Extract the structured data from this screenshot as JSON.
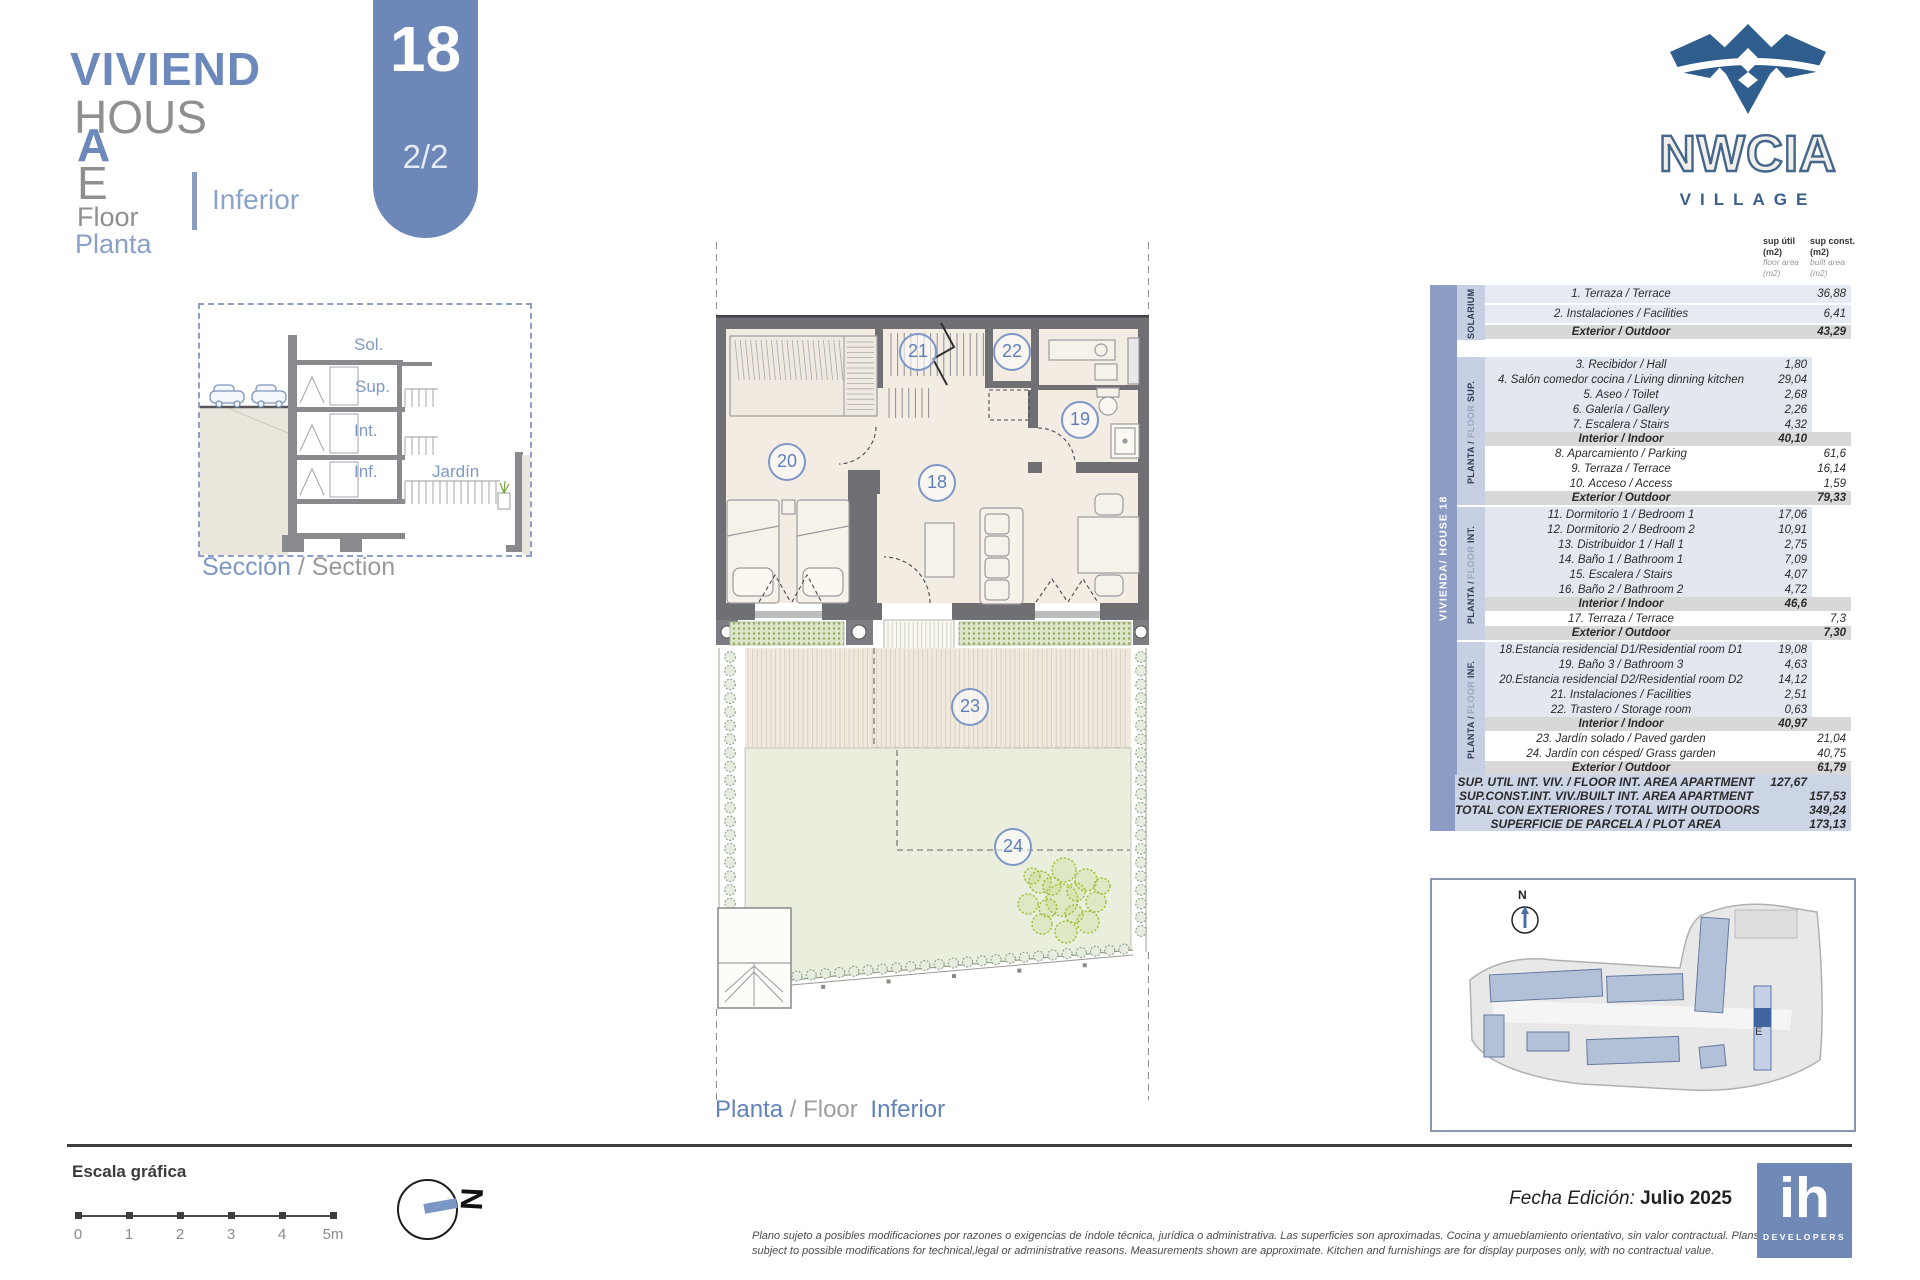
{
  "colors": {
    "accent_blue": "#6d87b8",
    "brand_blue": "#2e5d8e",
    "table_bar": "#8d9cc2"
  },
  "header": {
    "title_es_main": "VIVIEND",
    "title_es_wrap": "A",
    "title_en_main": "HOUS",
    "title_en_wrap": "E",
    "floor_label_en": "Floor",
    "floor_label_es": "Planta",
    "floor_name": "Inferior",
    "badge": {
      "house_number": "18",
      "page": "2/2"
    }
  },
  "brand": {
    "name": "NWCIA",
    "sub": "VILLAGE"
  },
  "section_figure": {
    "labels": {
      "sol": "Sol.",
      "sup": "Sup.",
      "int": "Int.",
      "inf": "Inf.",
      "jardin": "Jardín"
    },
    "caption_es": "Sección",
    "caption_rest": "/ Section"
  },
  "floor_plan": {
    "caption_es": "Planta",
    "caption_mid": "/ Floor",
    "caption_name": "Inferior",
    "rooms": [
      {
        "number": "18"
      },
      {
        "number": "19"
      },
      {
        "number": "20"
      },
      {
        "number": "21"
      },
      {
        "number": "22"
      },
      {
        "number": "23"
      },
      {
        "number": "24"
      }
    ]
  },
  "area_table": {
    "house_label": "VIVIENDA/ HOUSE 18",
    "columns": [
      {
        "bold": "sup útil",
        "bold_unit": "(m2)",
        "light": "floor area",
        "light_unit": "(m2)"
      },
      {
        "bold": "sup const.",
        "bold_unit": "(m2)",
        "light": "built area",
        "light_unit": "(m2)"
      }
    ],
    "sections": [
      {
        "p1": "SOLARIUM",
        "p2": "",
        "p3": "",
        "rows": [
          {
            "name": "1. Terraza / Terrace",
            "c1": "",
            "c2": "36,88",
            "type": "lightfull"
          },
          {
            "name": "2. Instalaciones / Facilities",
            "c1": "",
            "c2": "6,41",
            "type": "lightfull"
          },
          {
            "name": "Exterior / Outdoor",
            "c1": "",
            "c2": "43,29",
            "type": "subtotal"
          }
        ]
      },
      {
        "p1": "PLANTA /",
        "p2": "FLOOR",
        "p3": "SUP.",
        "rows": [
          {
            "name": "3. Recibidor / Hall",
            "c1": "1,80",
            "c2": "",
            "type": "light"
          },
          {
            "name": "4. Salón comedor cocina / Living dinning kitchen",
            "c1": "29,04",
            "c2": "",
            "type": "light"
          },
          {
            "name": "5. Aseo / Toilet",
            "c1": "2,68",
            "c2": "",
            "type": "light"
          },
          {
            "name": "6. Galería / Gallery",
            "c1": "2,26",
            "c2": "",
            "type": "light"
          },
          {
            "name": "7. Escalera / Stairs",
            "c1": "4,32",
            "c2": "",
            "type": "light"
          },
          {
            "name": "Interior / Indoor",
            "c1": "40,10",
            "c2": "",
            "type": "subtotal"
          },
          {
            "name": "8. Aparcamiento / Parking",
            "c1": "",
            "c2": "61,6",
            "type": "plain"
          },
          {
            "name": "9. Terraza / Terrace",
            "c1": "",
            "c2": "16,14",
            "type": "plain"
          },
          {
            "name": "10. Acceso / Access",
            "c1": "",
            "c2": "1,59",
            "type": "plain"
          },
          {
            "name": "Exterior / Outdoor",
            "c1": "",
            "c2": "79,33",
            "type": "subtotal"
          }
        ]
      },
      {
        "p1": "PLANTA /",
        "p2": "FLOOR",
        "p3": "INT.",
        "rows": [
          {
            "name": "11. Dormitorio 1 / Bedroom 1",
            "c1": "17,06",
            "c2": "",
            "type": "light"
          },
          {
            "name": "12.  Dormitorio 2 / Bedroom 2",
            "c1": "10,91",
            "c2": "",
            "type": "light"
          },
          {
            "name": "13. Distribuidor 1 / Hall 1",
            "c1": "2,75",
            "c2": "",
            "type": "light"
          },
          {
            "name": "14. Baño 1 / Bathroom 1",
            "c1": "7,09",
            "c2": "",
            "type": "light"
          },
          {
            "name": "15. Escalera / Stairs",
            "c1": "4,07",
            "c2": "",
            "type": "light"
          },
          {
            "name": "16. Baño 2 / Bathroom 2",
            "c1": "4,72",
            "c2": "",
            "type": "light"
          },
          {
            "name": "Interior / Indoor",
            "c1": "46,6",
            "c2": "",
            "type": "subtotal"
          },
          {
            "name": "17. Terraza / Terrace",
            "c1": "",
            "c2": "7,3",
            "type": "plain"
          },
          {
            "name": "Exterior / Outdoor",
            "c1": "",
            "c2": "7,30",
            "type": "subtotal"
          }
        ]
      },
      {
        "p1": "PLANTA /",
        "p2": "FLOOR",
        "p3": "INF.",
        "rows": [
          {
            "name": "18.Estancia residencial D1/Residential room D1",
            "c1": "19,08",
            "c2": "",
            "type": "light"
          },
          {
            "name": "19. Baño 3 / Bathroom 3",
            "c1": "4,63",
            "c2": "",
            "type": "light"
          },
          {
            "name": "20.Estancia residencial D2/Residential room D2",
            "c1": "14,12",
            "c2": "",
            "type": "light"
          },
          {
            "name": "21. Instalaciones / Facilities",
            "c1": "2,51",
            "c2": "",
            "type": "light"
          },
          {
            "name": "22. Trastero / Storage room",
            "c1": "0,63",
            "c2": "",
            "type": "light"
          },
          {
            "name": "Interior / Indoor",
            "c1": "40,97",
            "c2": "",
            "type": "subtotal"
          },
          {
            "name": "23. Jardín solado / Paved garden",
            "c1": "",
            "c2": "21,04",
            "type": "plain"
          },
          {
            "name": "24. Jardín con césped/ Grass garden",
            "c1": "",
            "c2": "40,75",
            "type": "plain"
          },
          {
            "name": "Exterior / Outdoor",
            "c1": "",
            "c2": "61,79",
            "type": "subtotal"
          }
        ]
      }
    ],
    "summary": [
      {
        "name": "SUP. UTIL INT. VIV. / FLOOR INT. AREA APARTMENT",
        "c1": "127,67",
        "c2": ""
      },
      {
        "name": "SUP.CONST.INT. VIV./BUILT INT. AREA APARTMENT",
        "c1": "",
        "c2": "157,53"
      },
      {
        "name": "TOTAL CON EXTERIORES / TOTAL WITH OUTDOORS",
        "c1": "",
        "c2": "349,24"
      },
      {
        "name": "SUPERFICIE DE PARCELA / PLOT AREA",
        "c1": "",
        "c2": "173,13"
      }
    ]
  },
  "site_plan": {
    "north_label": "N",
    "unit_label": "E"
  },
  "scale_bar": {
    "title": "Escala gráfica",
    "ticks": [
      "0",
      "1",
      "2",
      "3",
      "4",
      "5m"
    ]
  },
  "compass": {
    "letter": "N"
  },
  "footer": {
    "date_label": "Fecha Edición:",
    "date_value": "Julio 2025",
    "disclaimer_line1": "Plano sujeto a posibles modificaciones por razones o exigencias de índole técnica,  jurídica o administrativa. Las superficies son aproximadas. Cocina y amueblamiento orientativo, sin valor contractual.   Plans",
    "disclaimer_line2": "subject to possible modifications for technical,legal or administrative reasons. Measurements shown are approximate. Kitchen and furnishings are for display purposes only, with no contractual value.",
    "developer": {
      "name": "ih",
      "sub": "DEVELOPERS"
    }
  }
}
